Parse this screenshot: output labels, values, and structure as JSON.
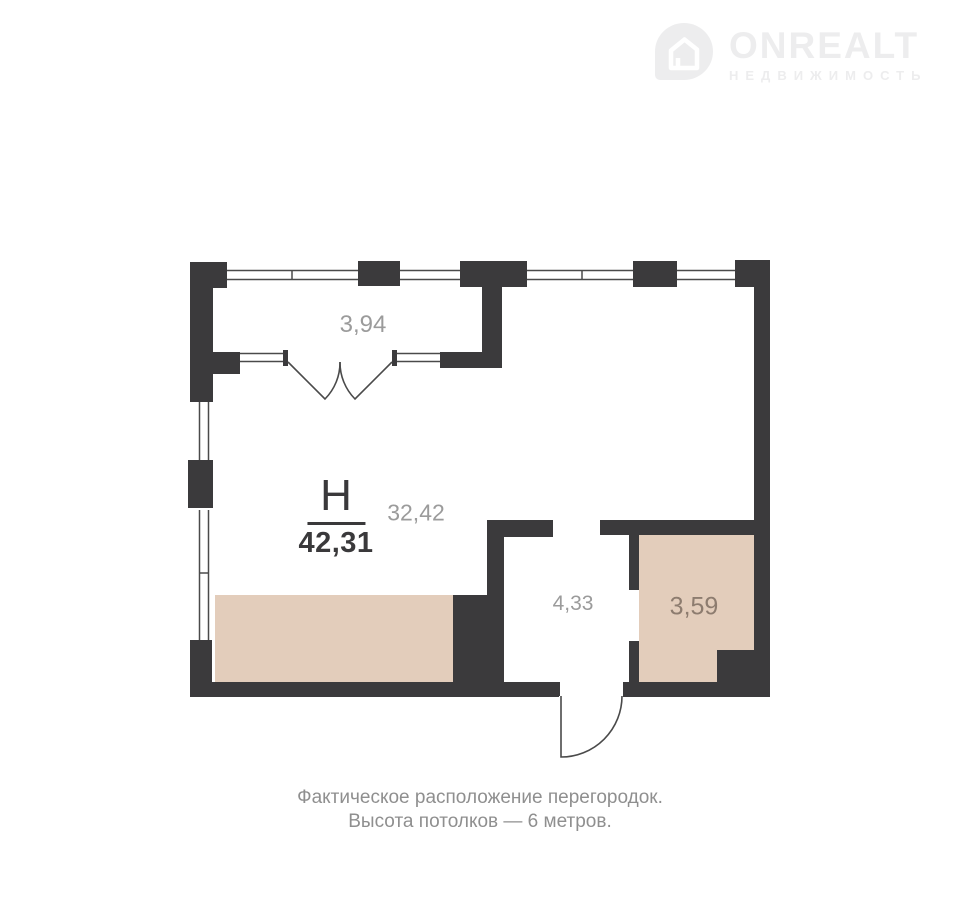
{
  "logo": {
    "icon": "house-pin-icon",
    "brand": "ONREALT",
    "tagline": "НЕДВИЖИМОСТЬ"
  },
  "plan": {
    "unit_label": "Н",
    "total_area": "42,31",
    "main_room_area": "32,42",
    "balcony_area": "3,94",
    "hall_area": "4,33",
    "storage_area": "3,59"
  },
  "caption": {
    "line1": "Фактическое расположение перегородок.",
    "line2": "Высота потолков — 6 метров."
  },
  "colors": {
    "wall": "#3b3a3c",
    "window_line": "#4a4a4a",
    "zone_fill": "#e3cdbb",
    "label_gray": "#9b9b9b",
    "label_dark": "#3a393b",
    "label_brown": "#8d7c6f",
    "caption_gray": "#8f8f8f",
    "logo_gray": "#ededee"
  }
}
